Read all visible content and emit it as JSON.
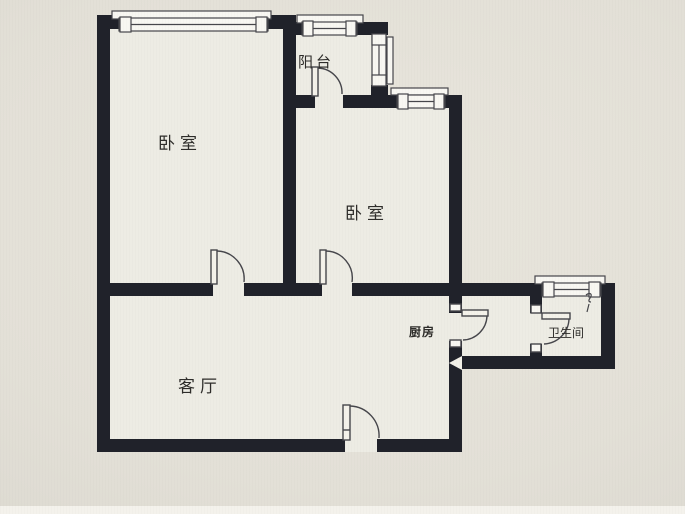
{
  "meta": {
    "title": "两室一厅户型图",
    "type": "apartment-floor-plan-photo"
  },
  "palette": {
    "wall": "#20222a",
    "line": "#46464b",
    "room_fill": "#edece4",
    "paper": "#e3e0d7",
    "fixture_white": "#f8f7f2",
    "arrow": "#f2f0e8",
    "text": "#2e2d2a"
  },
  "rooms": {
    "bedroom_left": {
      "label": "卧室"
    },
    "balcony": {
      "label": "阳台"
    },
    "bedroom_right": {
      "label": "卧室"
    },
    "kitchen": {
      "label": "厨房"
    },
    "bathroom": {
      "label": "卫生间"
    },
    "living_room": {
      "label": "客厅"
    }
  },
  "annotations": {
    "entry_arrow": "left-pointing-triangle",
    "bathroom_mark": "small-squiggle-fixture-mark"
  },
  "openings": {
    "windows": [
      "bedroom-left-top",
      "balcony-top",
      "balcony-right",
      "bedroom-right-top",
      "bathroom-top"
    ],
    "doors": [
      "bedroom-left",
      "bedroom-right",
      "balcony",
      "kitchen",
      "bathroom",
      "entry"
    ]
  }
}
